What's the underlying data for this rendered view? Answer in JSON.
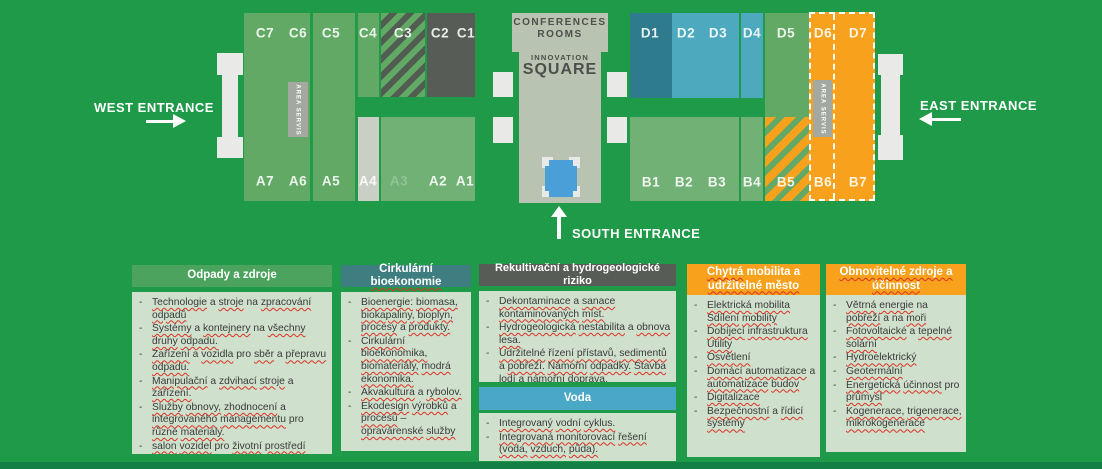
{
  "colors": {
    "bg": "#1e9a48",
    "hall-green": "#62a966",
    "hall-green-light": "#72b176",
    "hall-dark": "#575c56",
    "hall-teal": "#2f7b8e",
    "hall-blue": "#4da9bd",
    "orange": "#f7a11c",
    "building": "#b9c3b1",
    "gray-strip": "#c9cfc5",
    "servis-gray": "#a3a8a0",
    "stripe-dark": "#515d51",
    "legend-body": "#cfe0cc",
    "legend-green": "#4ba35d",
    "legend-teal": "#3f7e80",
    "legend-blue": "#48a8c5",
    "squiggle": "#dd3226",
    "text-dark": "#3a3a3a"
  },
  "map": {
    "west_entrance": "WEST ENTRANCE",
    "east_entrance": "EAST ENTRANCE",
    "south_entrance": "SOUTH ENTRANCE",
    "conference_line1": "CONFERENCES",
    "conference_line2": "ROOMS",
    "innovation_line1": "INNOVATION",
    "innovation_line2": "SQUARE",
    "area_service_left": "AREA SERVIS",
    "area_service_right": "AREA SERVIS",
    "halls": {
      "C7": "C7",
      "C6": "C6",
      "C5": "C5",
      "C4": "C4",
      "C3": "C3",
      "C2": "C2",
      "C1": "C1",
      "A7": "A7",
      "A6": "A6",
      "A5": "A5",
      "A4": "A4",
      "A3": "A3",
      "A2": "A2",
      "A1": "A1",
      "D1": "D1",
      "D2": "D2",
      "D3": "D3",
      "D4": "D4",
      "D5": "D5",
      "D6": "D6",
      "D7": "D7",
      "B1": "B1",
      "B2": "B2",
      "B3": "B3",
      "B4": "B4",
      "B5": "B5",
      "B6": "B6",
      "B7": "B7"
    }
  },
  "legend": [
    {
      "id": "odpady-a-zdroje",
      "header": [
        {
          "t": "Odpady a zdroje",
          "sq": false
        }
      ],
      "header_bg": "green",
      "items": [
        "Technologie a stroje na zpracování odpadů",
        "Systémy a kontejnery na všechny druhy odpadu.",
        "Zařízení a vozidla pro sběr a přepravu odpadu.",
        "Manipulační a zdvihací stroje a zařízení.",
        "Služby obnovy, zhodnocení a integrovaného managementu pro různé materiály.",
        "salon vozidel pro životní prostředí"
      ]
    },
    {
      "id": "cirkularni-bioekonomie",
      "header": [
        {
          "t": "Cirkulární ",
          "sq": false
        },
        {
          "t": "bioekonomie",
          "sq": true
        }
      ],
      "header_bg": "teal",
      "items": [
        "Bioenergie: biomasa, biokapaliny, bioplyn, procesy a produkty.",
        "Cirkulární bioekonomika, biomateriály, modrá ekonomika.",
        "Akvakultura a rybolov.",
        "Ekodesign výrobků a procesů – opravárenské služby"
      ]
    },
    {
      "id": "rekultivacni-riziko",
      "header": [
        {
          "t": "Rekultivační a hydrogeologické riziko",
          "sq": false
        }
      ],
      "header_bg": "dark",
      "items": [
        "Dekontaminace a sanace kontaminovaných míst.",
        "Hydrogeologická nestabilita a obnova lesa.",
        "Udržitelné řízení přístavů, sedimentů a pobřeží. Námořní odpadky. Stavba lodí a námořní doprava."
      ]
    },
    {
      "id": "voda",
      "header": [
        {
          "t": "Voda",
          "sq": false
        }
      ],
      "header_bg": "blue",
      "items": [
        "Integrovaný vodní cyklus.",
        "Integrovaná monitorovací řešení (voda, vzduch, půda)."
      ]
    },
    {
      "id": "chytra-mobilita",
      "header": [
        {
          "t": "Chytrá",
          "sq": true
        },
        {
          "t": " mobilita a ",
          "sq": false
        },
        {
          "t": "udržitelné město",
          "sq": true
        }
      ],
      "header_bg": "orange",
      "items": [
        "Elektrická mobilita Sdílení mobility",
        "Dobíjecí infrastruktura Utility",
        "Osvětlení",
        "Domácí automatizace a automatizace budov",
        "Digitalizace",
        "Bezpečnostní a řídicí systémy"
      ]
    },
    {
      "id": "obnovitelne-zdroje",
      "header": [
        {
          "t": "Obnovitelné zdroje a ",
          "sq": true
        },
        {
          "t": "účinnost",
          "sq": true
        }
      ],
      "header_bg": "orange",
      "items": [
        "Větrná energie na pobřeží a na moři",
        "Fotovoltaické a tepelné solární",
        "Hydroelektrický",
        "Geotermální",
        "Energetická účinnost pro průmysl",
        "Kogenerace, trigenerace, mikrokogenerace"
      ]
    }
  ]
}
